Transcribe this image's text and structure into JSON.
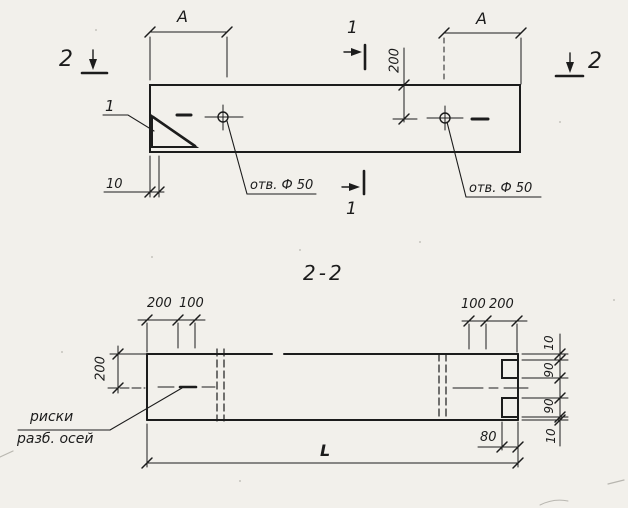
{
  "sheet": {
    "kind": "engineering-drawing",
    "section_title": "2-2"
  },
  "top_view": {
    "dim_a_left": "A",
    "dim_a_right": "A",
    "dim_200": "200",
    "dim_10": "10",
    "section1_mark_top": "1",
    "section1_mark_bottom": "1",
    "section2_mark_left": "2",
    "section2_mark_right": "2",
    "detail_mark": "1",
    "hole_label_left": "отв. Ф 50",
    "hole_label_right": "отв. Ф 50"
  },
  "section_view": {
    "title": "2-2",
    "dim_200_left": "200",
    "dim_top_left_200": "200",
    "dim_top_left_100": "100",
    "dim_top_right_100": "100",
    "dim_top_right_200": "200",
    "dim_right_10_top": "10",
    "dim_right_90_top": "90",
    "dim_right_90_bottom": "90",
    "dim_right_10_bottom": "10",
    "dim_80": "80",
    "dim_length": "L",
    "axis_label_line1": "риски",
    "axis_label_line2": "разб. осей"
  },
  "colors": {
    "paper": "#f2f0eb",
    "ink": "#1c1c1c"
  }
}
